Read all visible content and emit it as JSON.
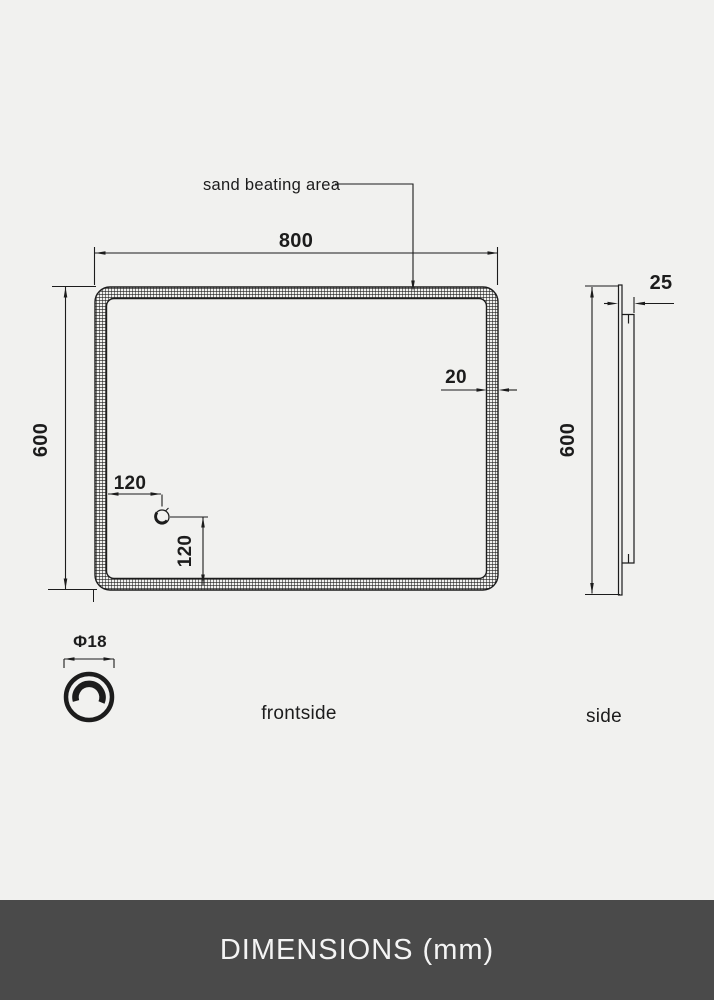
{
  "drawing": {
    "annotation": {
      "sand_beating_area": "sand beating area"
    },
    "front": {
      "width_label": "800",
      "height_label": "600",
      "frame_thickness_label": "20",
      "sensor_offset_x_label": "120",
      "sensor_offset_y_label": "120",
      "view_label": "frontside"
    },
    "sensor_icon": {
      "diameter_label": "Φ18"
    },
    "side": {
      "depth_label": "25",
      "height_label": "600",
      "view_label": "side"
    }
  },
  "footer": {
    "title": "DIMENSIONS (mm)"
  },
  "colors": {
    "background": "#f1f1ef",
    "line": "#1c1c1c",
    "footer_background": "#4a4a4a",
    "footer_text": "#f4f4f4"
  }
}
